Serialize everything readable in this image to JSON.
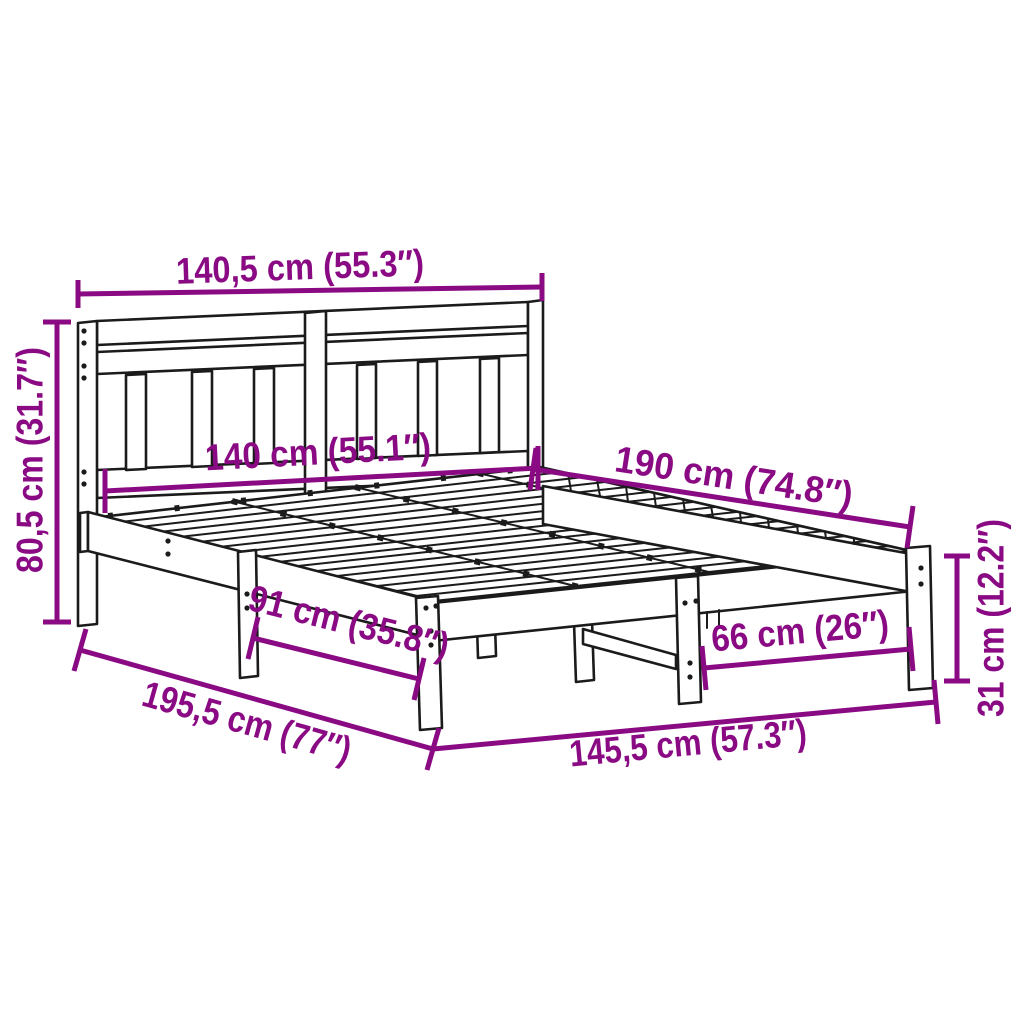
{
  "diagram": {
    "subject": "bed-frame-dimension-drawing",
    "colors": {
      "dimension_accent": "#8A0A84",
      "outline": "#1b1b1b",
      "background": "#ffffff"
    },
    "dims": {
      "headboard_width": "140,5 cm (55.3″)",
      "headboard_height": "80,5 cm (31.7″)",
      "inner_width": "140 cm (55.1″)",
      "bed_length": "190 cm (74.8″)",
      "side_leg_span": "91 cm (35.8″)",
      "front_leg_span": "66 cm (26″)",
      "total_length": "195,5 cm (77″)",
      "total_width": "145,5 cm (57.3″)",
      "base_height": "31 cm (12.2″)"
    }
  }
}
